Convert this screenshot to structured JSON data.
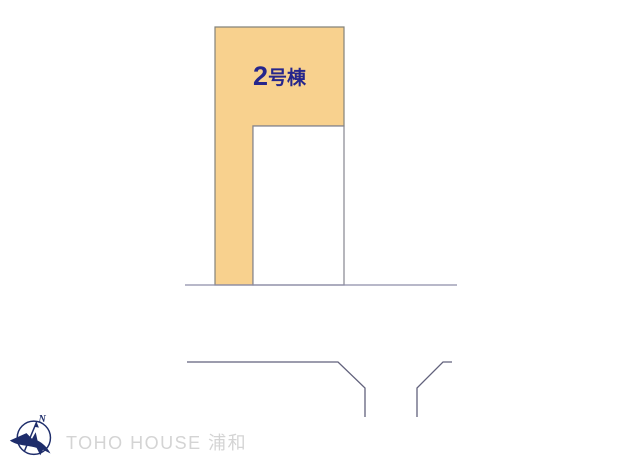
{
  "diagram": {
    "plot_label_number": "2",
    "plot_label_suffix": "号棟"
  },
  "footer": {
    "brand_text": "TOHO HOUSE 浦和",
    "compass_north_label": "N"
  },
  "colors": {
    "plot_fill": "#F8D18E",
    "plot_border": "#84837a",
    "cutout_border": "#85858f",
    "label_color": "#26268c",
    "road_line": "#8d8da9",
    "road_line_dark": "#62627c",
    "brand_text_color": "#d4d4d4",
    "logo_navy": "#1e2d6b"
  }
}
